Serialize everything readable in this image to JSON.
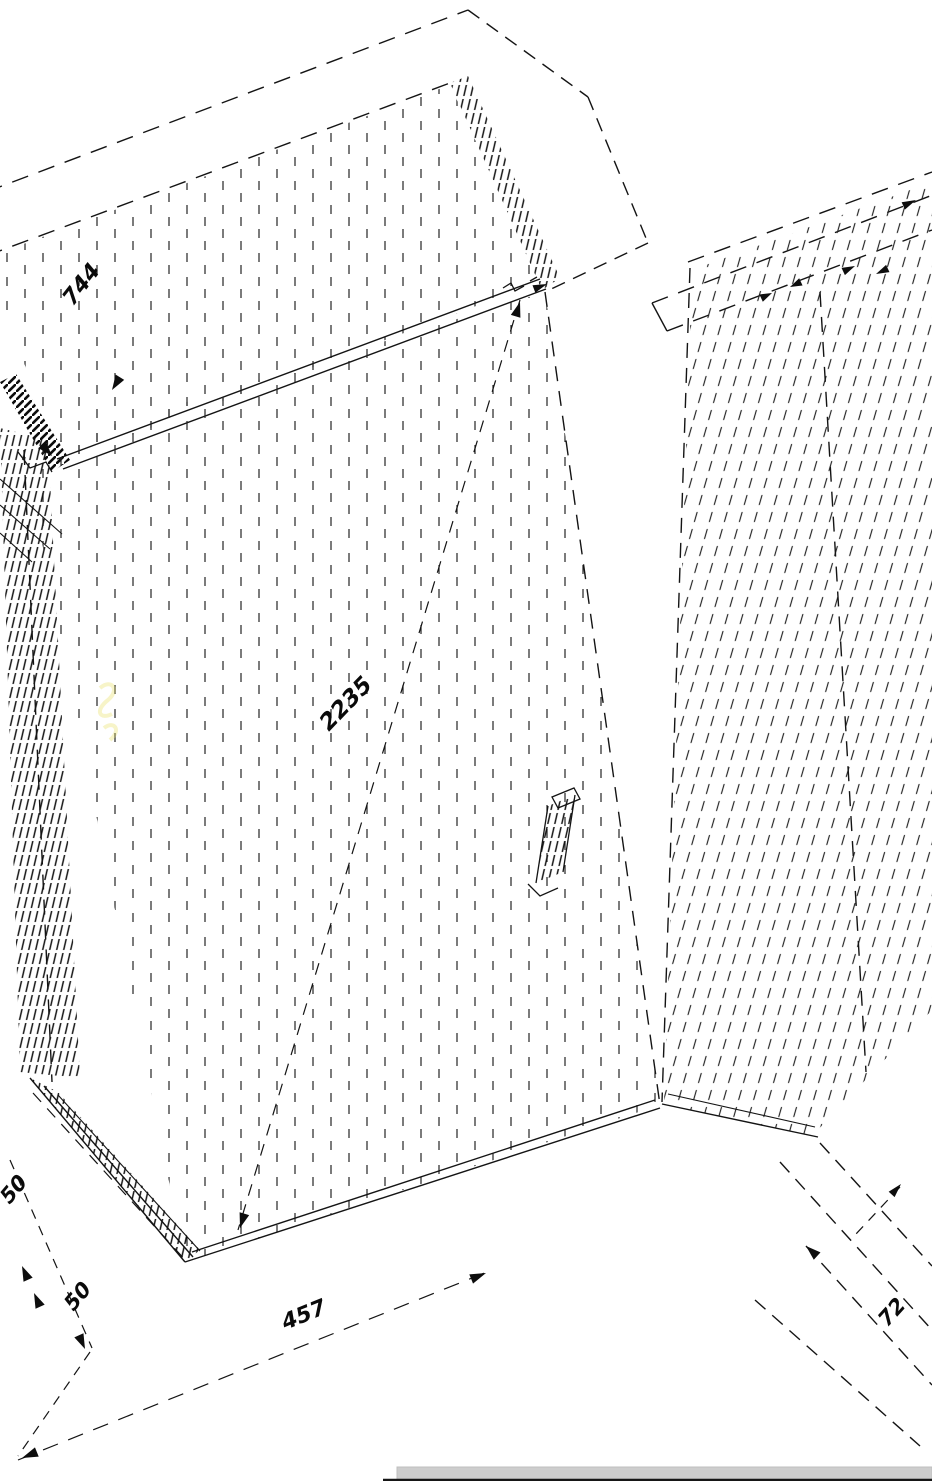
{
  "drawing": {
    "kind": "isometric-cad-line-drawing",
    "line_color": "#141414",
    "background_color": "#ffffff",
    "dimensions": {
      "top_panel_width": {
        "value": "744",
        "location": "top-left panel"
      },
      "cabinet_height": {
        "value": "2235",
        "location": "center of left side panel"
      },
      "bottom_depth": {
        "value": "457",
        "location": "bottom center dimension line"
      },
      "plinth_upper": {
        "value": "50",
        "location": "lower-left upper dimension"
      },
      "plinth_lower": {
        "value": "50",
        "location": "lower-left lower dimension"
      },
      "corner_offset": {
        "value": "72",
        "location": "bottom-right dimension"
      }
    },
    "footer": {
      "scrollbar_color": "#cdcdcd",
      "baseline_color": "#161616"
    },
    "artifact_color": "#e8df62"
  }
}
